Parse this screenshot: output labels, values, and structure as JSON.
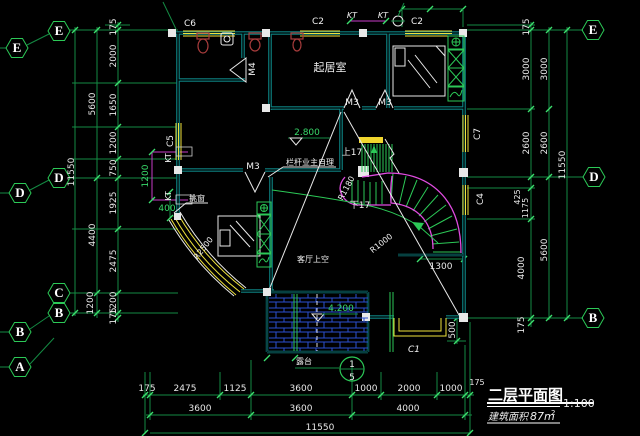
{
  "axes": {
    "left_outer": [
      "E",
      "D",
      "B",
      "A"
    ],
    "left_inner": [
      "E",
      "D",
      "C",
      "B"
    ],
    "right": [
      "E",
      "D",
      "B"
    ]
  },
  "dims": {
    "left_inner": [
      "175",
      "2000",
      "1650",
      "1200",
      "750",
      "1925",
      "2475",
      "1200",
      "175"
    ],
    "left_middle": [
      "5600",
      "4400",
      "1200"
    ],
    "left_total": "11550",
    "kt_shaft": "1200",
    "bay_offset": "400",
    "right_inner": [
      "175",
      "3000",
      "2600",
      "425",
      "1175",
      "4000",
      "175"
    ],
    "right_middle": [
      "3000",
      "2600",
      "5600"
    ],
    "right_total": "11550",
    "bottom_row1": [
      "175",
      "2475",
      "1125",
      "3600",
      "1000",
      "2000",
      "1000",
      "175"
    ],
    "bottom_row2": [
      "3600",
      "3600",
      "4000"
    ],
    "bottom_total": "11550",
    "stair_landing": "1300",
    "terrace_edge": "500"
  },
  "windows": {
    "c6": "C6",
    "c2a": "C2",
    "kt_a": "KT",
    "kt_b": "KT",
    "c2b": "C2",
    "c5": "C5",
    "kt_c": "KT",
    "kt_d": "KT",
    "c7": "C7",
    "c4": "C4",
    "c1": "C1"
  },
  "doors": {
    "m4": "M4",
    "m3_a": "M3",
    "m3_b": "M3",
    "m3_c": "M3"
  },
  "stair": {
    "up": "上17",
    "down": "下17",
    "r_outer": "R1180",
    "r_inner": "R1000"
  },
  "notes": {
    "living_room": "起居室",
    "void_above": "客厅上空",
    "railing": "栏杆业主自理",
    "bay_window": "挑窗",
    "terrace": "露台",
    "bay_radius": "R2500"
  },
  "levels": {
    "stair_landing": "2.800",
    "terrace": "4.200"
  },
  "section_marker": {
    "number": "1",
    "sheet": "5"
  },
  "title_block": {
    "title": "二层平面图",
    "scale": "1:100",
    "area_prefix": "建筑面积",
    "area_value": "87m",
    "area_exponent": "2"
  }
}
